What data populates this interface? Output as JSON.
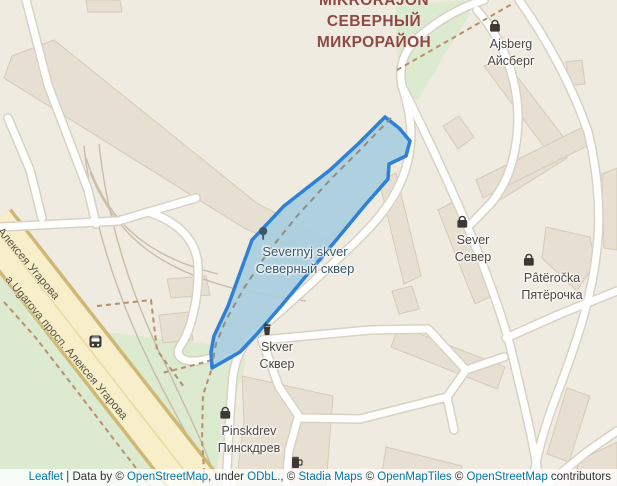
{
  "district": {
    "line1": "MIKRORAJON",
    "line2": "СЕВЕРНЫЙ",
    "line3": "МИКРОРАЙОН"
  },
  "park": {
    "latin": "Severnyj skver",
    "cyrillic": "Северный сквер"
  },
  "pois": {
    "ajsberg": {
      "latin": "Ajsberg",
      "cyrillic": "Айсберг",
      "icon": "shop-bag"
    },
    "sever": {
      "latin": "Sever",
      "cyrillic": "Север",
      "icon": "shop-bag"
    },
    "pyaterochka": {
      "latin": "Pâtëročka",
      "cyrillic": "Пятёрочка",
      "icon": "shop-bag"
    },
    "skver": {
      "latin": "Skver",
      "cyrillic": "Сквер",
      "icon": "drink-cup"
    },
    "pinskdrev": {
      "latin": "Pinskdrev",
      "cyrillic": "Пинскдрев",
      "icon": "shop-bag"
    }
  },
  "streets": {
    "upper": "Алексея Угарова",
    "lower": "а Ugarova просп. Алексея Угарова"
  },
  "attribution": {
    "parts": [
      {
        "text": "Leaflet",
        "link": true
      },
      {
        "text": " | Data by © ",
        "link": false
      },
      {
        "text": "OpenStreetMap",
        "link": true
      },
      {
        "text": ", under ",
        "link": false
      },
      {
        "text": "ODbL.",
        "link": true
      },
      {
        "text": ", © ",
        "link": false
      },
      {
        "text": "Stadia Maps",
        "link": true
      },
      {
        "text": " © ",
        "link": false
      },
      {
        "text": "OpenMapTiles",
        "link": true
      },
      {
        "text": " © ",
        "link": false
      },
      {
        "text": "OpenStreetMap",
        "link": true
      },
      {
        "text": " contributors",
        "link": false
      }
    ]
  },
  "colors": {
    "background": "#f0ebe1",
    "greenery": "#dceacf",
    "building": "#e7dfd2",
    "road_fill": "#ffffff",
    "road_casing": "#d8d2c4",
    "avenue_fill": "#f6efc9",
    "avenue_casing": "#d0b775",
    "park_fill": "#a9cede",
    "park_stroke": "#2e80d8",
    "district_text": "#8d4a44",
    "link_text": "#0078a8"
  }
}
